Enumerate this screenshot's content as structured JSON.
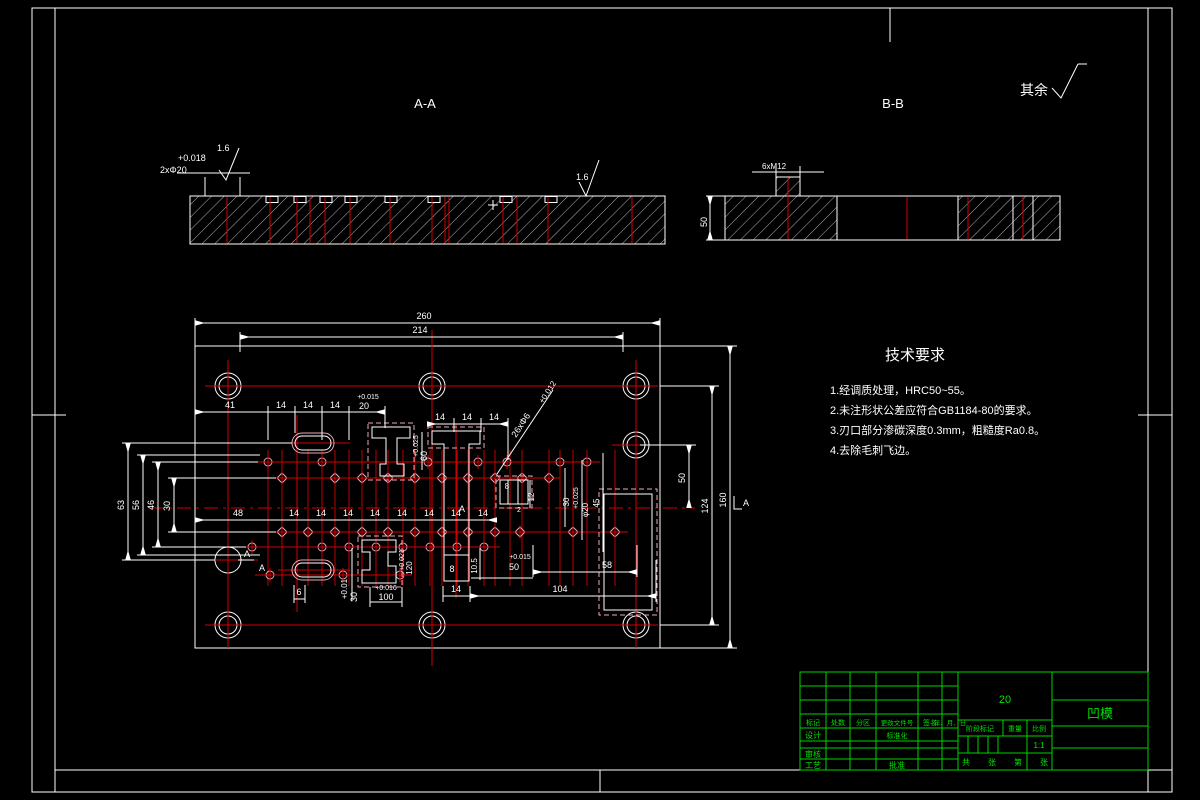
{
  "views": {
    "section_a_title": "A-A",
    "section_b_title": "B-B",
    "rest_note": "其余"
  },
  "section_a": {
    "tol": "+0.018",
    "hole_label": "2xΦ20",
    "finish": "1.6"
  },
  "section_b": {
    "thread_label": "6xM12",
    "height_dim": "50"
  },
  "tech_req": {
    "title": "技术要求",
    "items": [
      "1.经调质处理，HRC50~55。",
      "2.未注形状公差应符合GB1184-80的要求。",
      "3.刃口部分渗碳深度0.3mm，粗糙度Ra0.8。",
      "4.去除毛刺飞边。"
    ]
  },
  "plan": {
    "dim_260": "260",
    "dim_214": "214",
    "d41": "41",
    "pitch": "14",
    "slot_tol": "+0.015",
    "slot_dim": "20",
    "v_tol": "+0.025",
    "v60": "60",
    "d63": "63",
    "d56": "56",
    "d46": "46",
    "d30": "30",
    "r50": "50",
    "r124": "124",
    "r160": "160",
    "d48": "48",
    "b104": "104",
    "b58": "58",
    "fit_tol": "+0.015",
    "fit_dim": "50",
    "d105": "10.5",
    "d8": "8",
    "d2": "2",
    "d12": "12",
    "d30b": "30",
    "d45": "45",
    "hole_tol": "+0.025",
    "hole_dim": "φ20",
    "cut_tol": "+0.01",
    "cut30": "30",
    "key_tol": "+0.016",
    "key_dim": "100",
    "k2_tol": "+0.021",
    "k2_dim": "120",
    "d6": "6",
    "leader_tol": "+0.012",
    "leader_label": "26xΦ6",
    "sec_mark": "A"
  },
  "title_block": {
    "part_name": "凹模",
    "material": "20",
    "cols": [
      "标记",
      "处数",
      "分区",
      "更改文件号",
      "签名",
      "年、月、日"
    ],
    "design": "设计",
    "standard": "标准化",
    "check": "审核",
    "process": "工艺",
    "approve": "批准",
    "stage": "阶段标记",
    "weight": "重量",
    "scale": "比例",
    "scale_value": "1:1",
    "sheet": [
      "共",
      "张",
      "第",
      "张"
    ]
  }
}
